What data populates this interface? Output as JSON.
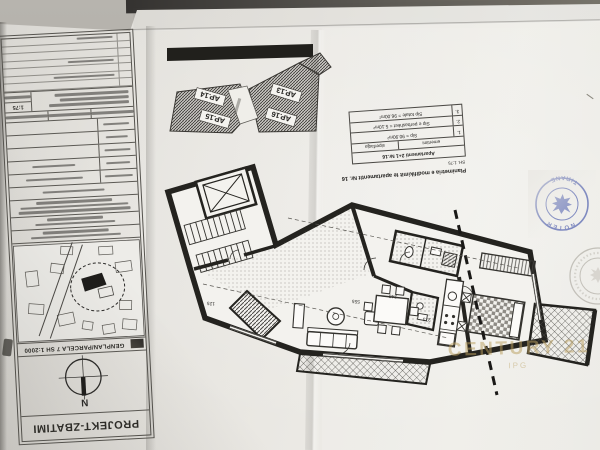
{
  "title_block": {
    "phase_label": "PROJEKT-ZBATIMI",
    "north_label": "N",
    "genplan_header": "GENPLAN/PARCELA 7 SH 1:2000",
    "scale_chip": "1:75"
  },
  "key_plan": {
    "units": [
      {
        "label": "AP.14"
      },
      {
        "label": "AP.15"
      },
      {
        "label": "AP.13"
      },
      {
        "label": "AP.16"
      }
    ]
  },
  "info_table": {
    "title": "Planimetria e modifikimit te apartamentit Nr. 16",
    "scale": "SH. 1:75",
    "header": "Apartamenti 2+1 Nr.16",
    "columns": {
      "name": "emertimi",
      "area": "siperfaqja"
    },
    "rows": [
      {
        "nr": "1.",
        "text": "Sip = 90.90m²"
      },
      {
        "nr": "2.",
        "text": "Sip e perbashket = 5.10m²"
      },
      {
        "nr": "3.",
        "text": "Sip totale = 96.00m²"
      }
    ]
  },
  "plan": {
    "dims": [
      {
        "v": "555"
      },
      {
        "v": "240"
      },
      {
        "v": "125"
      },
      {
        "v": "373"
      }
    ]
  },
  "stamps": {
    "blue_top": "NOTER",
    "blue_bottom": "TIRANE"
  },
  "watermark": {
    "brand": "CENTURY 21",
    "sub": "IPG"
  },
  "colors": {
    "paper": "#eae8e3",
    "ink": "#26251f",
    "stamp_blue": "#6472b6",
    "watermark_gold": "#b9a06a"
  }
}
